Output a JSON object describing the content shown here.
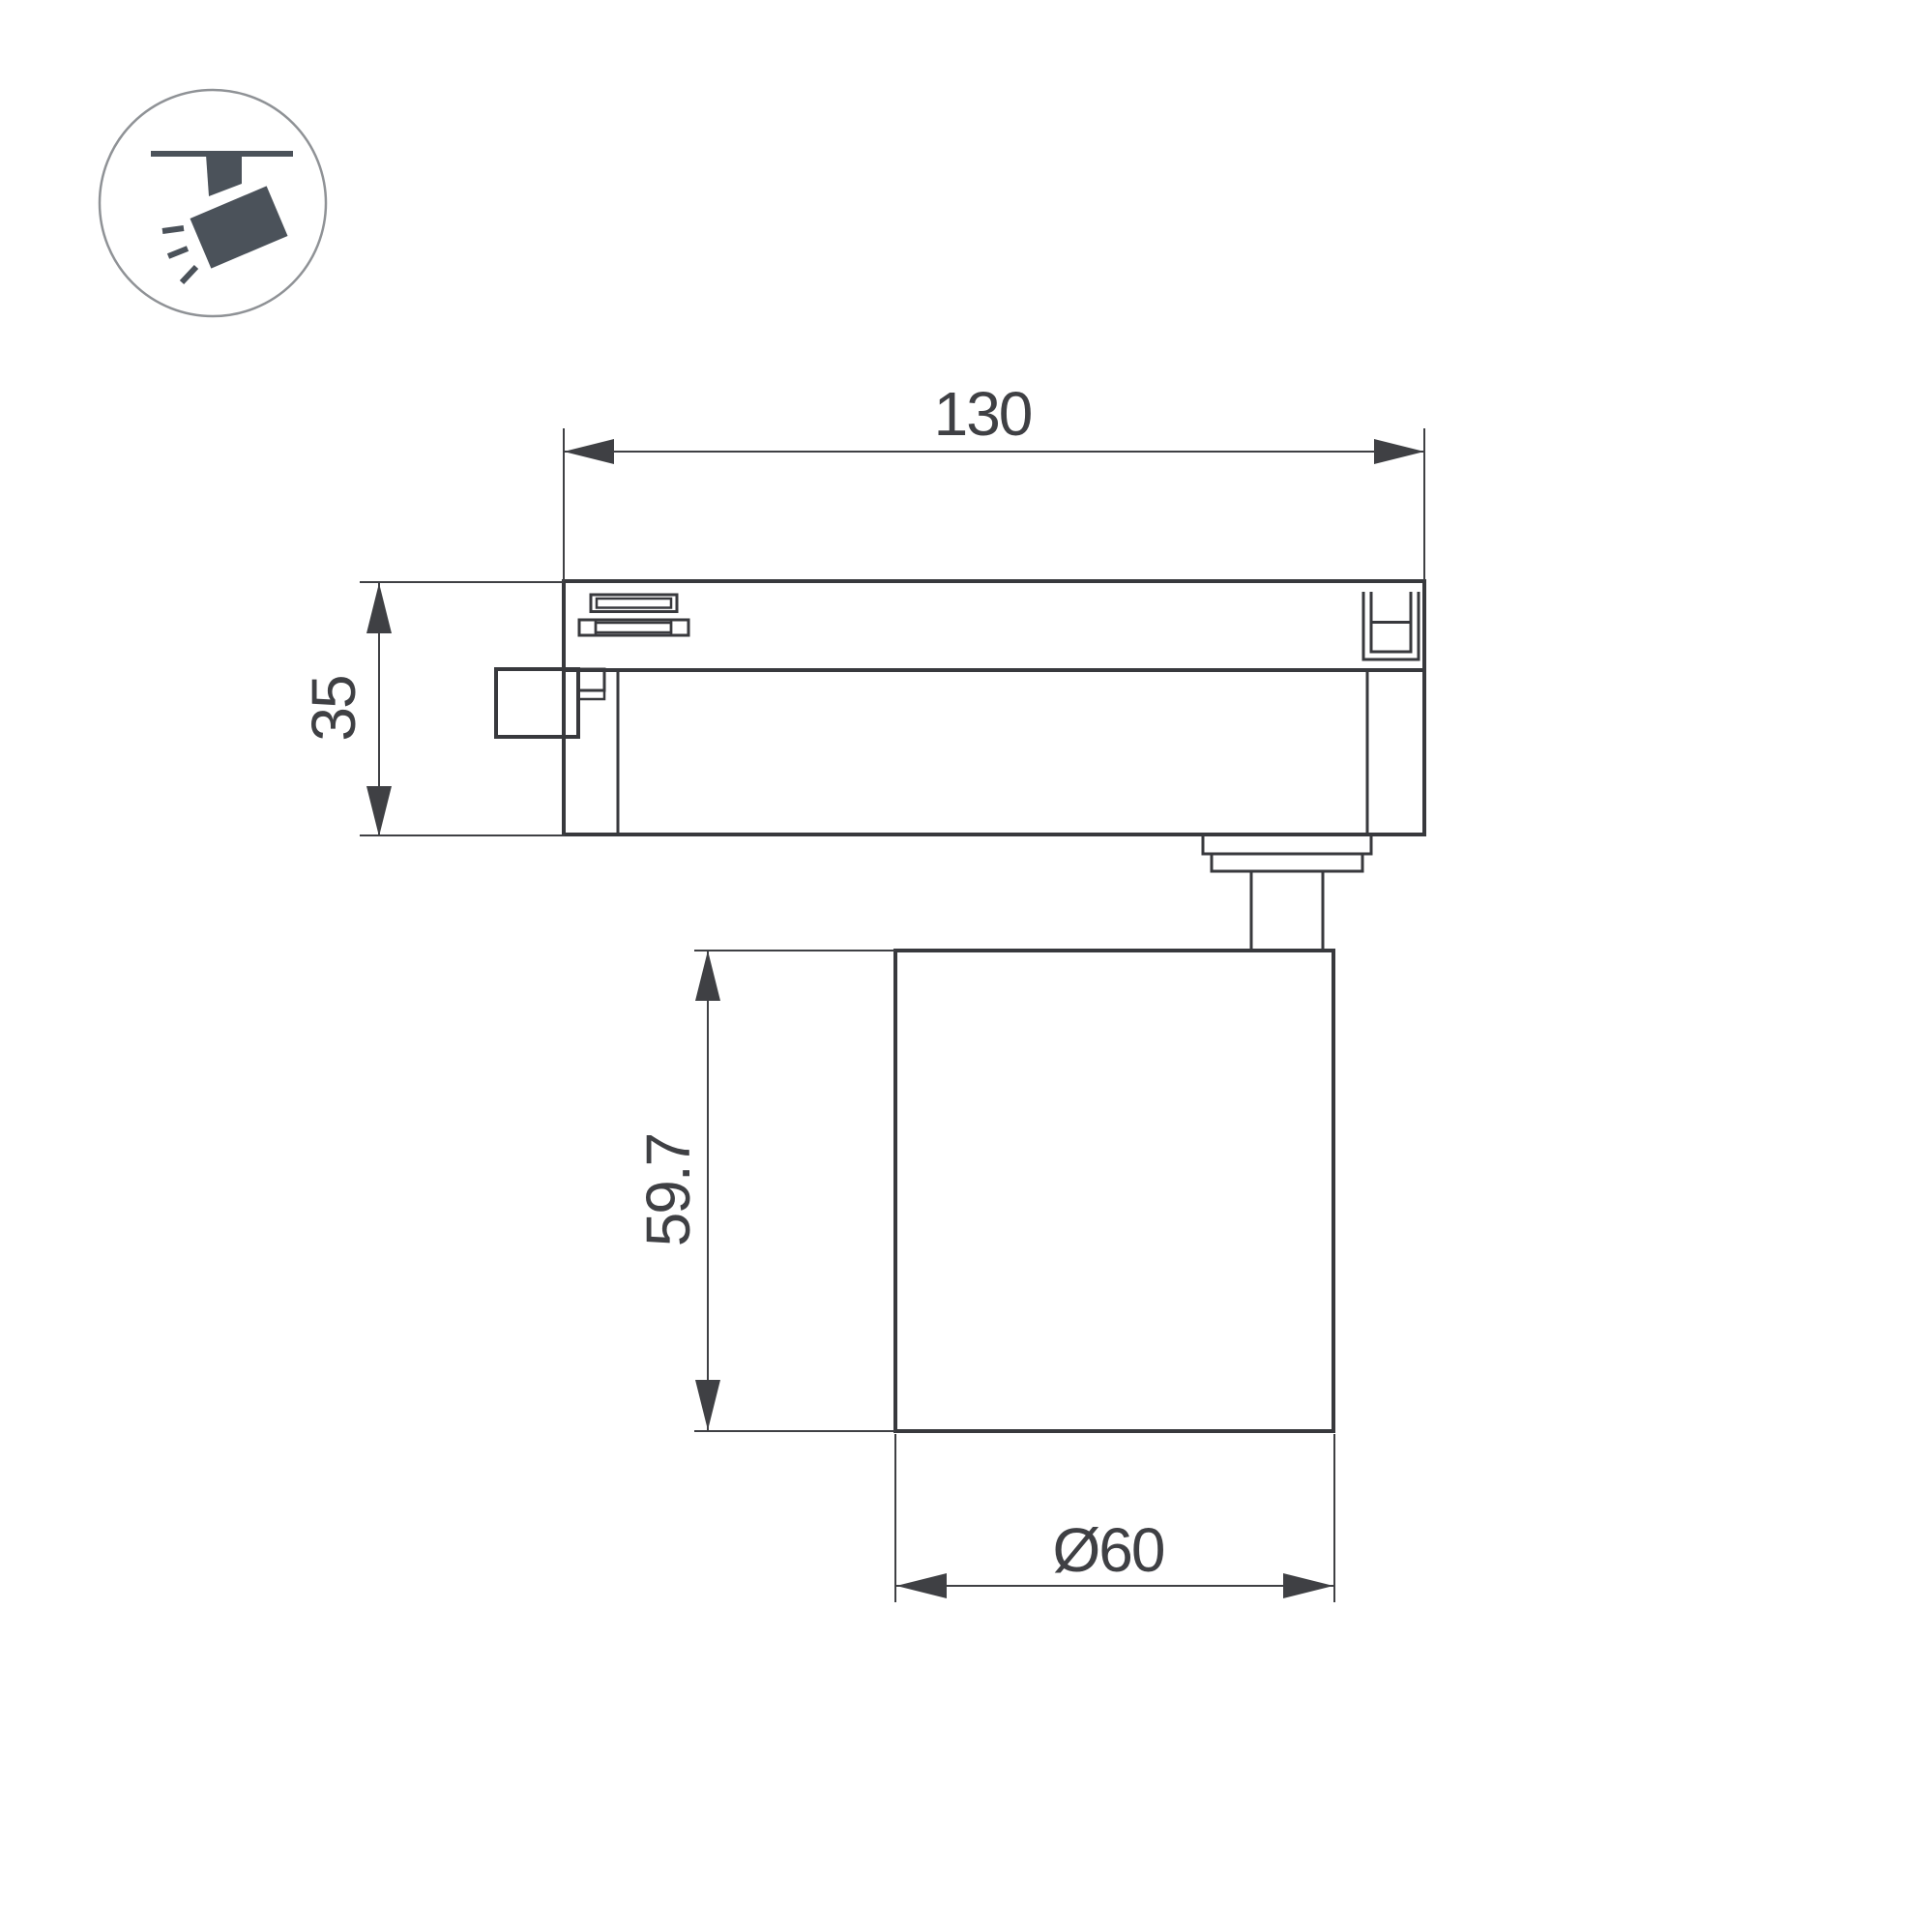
{
  "page": {
    "background": "#ffffff"
  },
  "icon": {
    "name": "ceiling-track-spotlight",
    "glyph_color": "#4b525a",
    "circle_color": "#8f9296"
  },
  "drawing": {
    "type": "dimensioned technical drawing of LED track light",
    "line_color": "#38393d",
    "dim_color": "#3f4044",
    "dimensions": {
      "track_width": "130",
      "adapter_height": "35",
      "lamp_height": "59.7",
      "lamp_diameter": "Ø60"
    }
  }
}
